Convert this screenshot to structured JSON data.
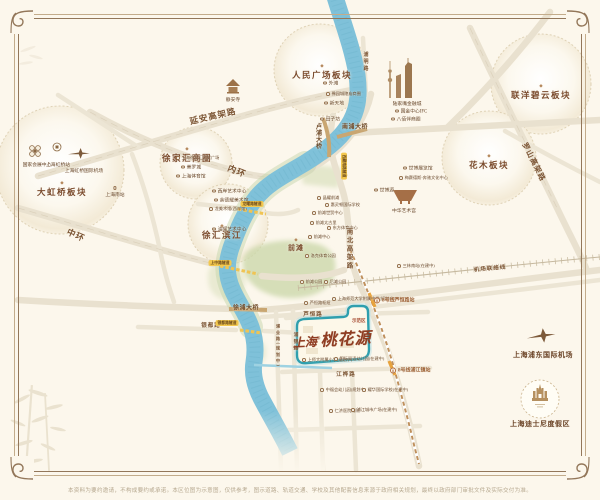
{
  "colors": {
    "background": "#fcf7ec",
    "frame": "#93775a",
    "river": "#7fc1d9",
    "park_green": "#ccd8ab",
    "road": "#eae2d0",
    "label_brown": "#7a4a2c",
    "project_red": "#8f3d22",
    "parcel_teal": "#2f9fae",
    "tunnel_yellow": "#f3c84f",
    "metro_orange": "#e8a33d"
  },
  "project": {
    "prefix": "上海",
    "reg": "®",
    "name": "桃花源"
  },
  "footer": {
    "disclaimer": "本资料为要约邀请，不构成要约或承诺。本区位图为示意图，仅供参考，图示道路、轨道交通、学校及其他配套信息来源于政府相关规划，最终以政府部门审批文件及实际交付为准。"
  },
  "districts": [
    {
      "label": "大虹桥板块",
      "x": 62,
      "y": 181
    },
    {
      "label": "徐家汇商圈",
      "x": 187,
      "y": 147
    },
    {
      "label": "徐汇滨江",
      "x": 222,
      "y": 224
    },
    {
      "label": "人民广场板块",
      "x": 322,
      "y": 64
    },
    {
      "label": "联洋碧云板块",
      "x": 541,
      "y": 84
    },
    {
      "label": "花木板块",
      "x": 489,
      "y": 154
    },
    {
      "label": "前滩",
      "x": 296,
      "y": 238,
      "mini": 1
    }
  ],
  "pois": [
    {
      "x": 37,
      "y": 161,
      "label": "国家会展中心",
      "d": "b",
      "dot": 0
    },
    {
      "x": 58,
      "y": 161,
      "label": "上海虹桥站",
      "d": "b",
      "dot": 0
    },
    {
      "x": 84,
      "y": 167,
      "label": "上海虹桥国际机场",
      "d": "b",
      "dot": 0
    },
    {
      "x": 115,
      "y": 186,
      "label": "上海南站",
      "d": "b"
    },
    {
      "x": 233,
      "y": 96,
      "label": "静安寺",
      "d": "b",
      "dot": 0
    },
    {
      "x": 176,
      "y": 158,
      "label": "上海徐家汇国贸广场",
      "fs": 4.2
    },
    {
      "x": 181,
      "y": 167,
      "label": "美罗城"
    },
    {
      "x": 176,
      "y": 176,
      "label": "上海体育馆"
    },
    {
      "x": 212,
      "y": 191,
      "label": "西岸艺术中心"
    },
    {
      "x": 214,
      "y": 200,
      "label": "余德耀美术馆"
    },
    {
      "x": 209,
      "y": 209,
      "label": "龙美术馆(西岸馆)",
      "fs": 4.2
    },
    {
      "x": 212,
      "y": 229,
      "label": "油罐艺术中心"
    },
    {
      "x": 323,
      "y": 83,
      "label": "外滩"
    },
    {
      "x": 326,
      "y": 94,
      "label": "豫园城隍庙商圈",
      "fs": 4.2
    },
    {
      "x": 324,
      "y": 103,
      "label": "新天地"
    },
    {
      "x": 320,
      "y": 119,
      "label": "田子坊"
    },
    {
      "x": 407,
      "y": 100,
      "label": "陆家嘴金融城",
      "d": "b",
      "dot": 0
    },
    {
      "x": 395,
      "y": 111,
      "label": "国金中心IFC"
    },
    {
      "x": 391,
      "y": 119,
      "label": "八佰伴商圈"
    },
    {
      "x": 403,
      "y": 168,
      "label": "世博展览馆"
    },
    {
      "x": 399,
      "y": 178,
      "label": "梅赛德斯-奔驰文化中心",
      "fs": 4.2
    },
    {
      "x": 374,
      "y": 190,
      "label": "世博源"
    },
    {
      "x": 404,
      "y": 207,
      "label": "中华艺术宫",
      "d": "b",
      "dot": 0
    },
    {
      "x": 317,
      "y": 198,
      "label": "晶耀前滩",
      "fs": 4.2
    },
    {
      "x": 325,
      "y": 205,
      "label": "惠灵顿国际学校",
      "fs": 4.2
    },
    {
      "x": 312,
      "y": 213,
      "label": "前滩世贸中心",
      "fs": 4.2
    },
    {
      "x": 310,
      "y": 223,
      "label": "前滩太古里",
      "fs": 4.2
    },
    {
      "x": 327,
      "y": 228,
      "label": "东方体育中心",
      "fs": 4.2
    },
    {
      "x": 308,
      "y": 237,
      "label": "前滩中心",
      "fs": 4.2
    },
    {
      "x": 305,
      "y": 256,
      "label": "洛克体育公园",
      "fs": 4.2
    },
    {
      "x": 300,
      "y": 282,
      "label": "前滩公园",
      "fs": 4.2
    },
    {
      "x": 324,
      "y": 282,
      "label": "后滩公园",
      "fs": 4.2
    },
    {
      "x": 397,
      "y": 266,
      "label": "三林南站(在建中)",
      "fs": 4.2
    },
    {
      "x": 304,
      "y": 303,
      "label": "芦恒路枢纽",
      "fs": 4.2
    },
    {
      "x": 332,
      "y": 299,
      "label": "上海师范大学附属中学(规划中)",
      "fs": 4.2
    },
    {
      "x": 302,
      "y": 360,
      "label": "上师大附属小学(规划中)",
      "fs": 4.2
    },
    {
      "x": 334,
      "y": 359,
      "label": "国际双语幼儿园(在建中)",
      "fs": 4.2
    },
    {
      "x": 320,
      "y": 390,
      "label": "中福会幼儿园(规划中)",
      "fs": 4.2
    },
    {
      "x": 362,
      "y": 390,
      "label": "耀华国际学校(在建中)",
      "fs": 4.2
    },
    {
      "x": 329,
      "y": 411,
      "label": "仁济医院南院",
      "fs": 4.2
    },
    {
      "x": 351,
      "y": 410,
      "label": "浦江城市广场(在建中)",
      "fs": 4.2
    },
    {
      "x": 352,
      "y": 321,
      "label": "示范区",
      "cls": "accent",
      "dot": 0
    },
    {
      "x": 543,
      "y": 350,
      "label": "上海浦东国际机场",
      "d": "b",
      "dot": 0,
      "cls": "lg"
    },
    {
      "x": 540,
      "y": 419,
      "label": "上海迪士尼度假区",
      "d": "b",
      "dot": 0,
      "cls": "lg"
    }
  ],
  "road_labels": [
    {
      "x": 213,
      "y": 116,
      "label": "延安高架路",
      "rot": -13,
      "fs": 8.5
    },
    {
      "x": 237,
      "y": 171,
      "label": "内环",
      "rot": 22,
      "fs": 8.5
    },
    {
      "x": 76,
      "y": 235,
      "label": "中环",
      "rot": 24,
      "fs": 8.5
    },
    {
      "x": 348,
      "y": 249,
      "label": "南北高架路",
      "vert": 1,
      "fs": 6.5
    },
    {
      "x": 534,
      "y": 162,
      "label": "罗山高架路",
      "rot": 63,
      "fs": 7.5
    },
    {
      "x": 490,
      "y": 268,
      "label": "机场联络线",
      "rot": -5,
      "fs": 5.5
    },
    {
      "x": 365,
      "y": 62,
      "label": "浦明路",
      "vert": 1,
      "fs": 5
    },
    {
      "x": 211,
      "y": 325,
      "label": "银都路",
      "fs": 5.5
    },
    {
      "x": 313,
      "y": 314,
      "label": "芦恒路",
      "fs": 5.5
    },
    {
      "x": 346,
      "y": 374,
      "label": "江桦路",
      "fs": 5.5
    },
    {
      "x": 278,
      "y": 346,
      "label": "浦业路(规划中)",
      "vert": 1,
      "fs": 4.2
    },
    {
      "x": 295,
      "y": 342,
      "label": "浦锦路",
      "vert": 1,
      "fs": 4.8
    },
    {
      "x": 318,
      "y": 136,
      "label": "卢浦大桥",
      "vert": 1,
      "fs": 6,
      "cls": "bridge"
    },
    {
      "x": 355,
      "y": 126,
      "label": "南浦大桥",
      "fs": 6,
      "cls": "bridge"
    },
    {
      "x": 246,
      "y": 307,
      "label": "徐浦大桥",
      "fs": 6,
      "cls": "bridge"
    }
  ],
  "stations": [
    {
      "x": 374,
      "y": 300,
      "label": "8号线芦恒路站"
    },
    {
      "x": 390,
      "y": 370,
      "label": "8号线浦江镇站"
    }
  ],
  "tunnels": [
    {
      "x": 220,
      "y": 263,
      "label": "上中路隧道"
    },
    {
      "x": 252,
      "y": 204,
      "label": "龙耀路隧道"
    },
    {
      "x": 227,
      "y": 323,
      "label": "银都路隧道"
    },
    {
      "x": 344,
      "y": 166,
      "label": "西藏南路隧道",
      "rot": 90
    }
  ]
}
